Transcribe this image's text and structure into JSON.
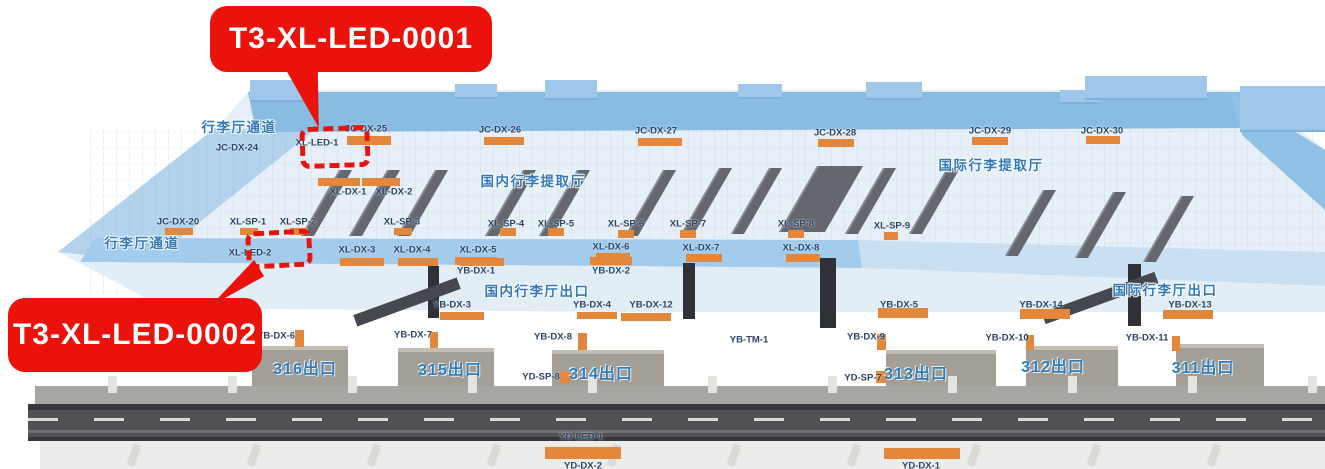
{
  "callouts": [
    {
      "id": "T3-XL-LED-0001",
      "label": "T3-XL-LED-0001"
    },
    {
      "id": "T3-XL-LED-0002",
      "label": "T3-XL-LED-0002"
    }
  ],
  "colors": {
    "callout_red": "#ea120b",
    "orange_marker": "#e2873b",
    "code_text": "#2b4568",
    "area_text": "#3279ba",
    "exit_text": "#2e7dbd"
  },
  "map": {
    "areas": [
      [
        239,
        126,
        "行李厅通道"
      ],
      [
        142,
        242,
        "行李厅通道"
      ],
      [
        533,
        180,
        "国内行李提取厅"
      ],
      [
        991,
        164,
        "国际行李提取厅"
      ],
      [
        537,
        290,
        "国内行李厅出口"
      ],
      [
        1165,
        289,
        "国际行李厅出口"
      ]
    ],
    "exits": [
      [
        305,
        367,
        "316出口"
      ],
      [
        450,
        368,
        "315出口"
      ],
      [
        601,
        372,
        "314出口"
      ],
      [
        916,
        372,
        "313出口"
      ],
      [
        1053,
        365,
        "312出口"
      ],
      [
        1203,
        366,
        "311出口"
      ]
    ],
    "codes": [
      [
        237,
        148,
        "JC-DX-24"
      ],
      [
        366,
        129,
        "JC-DX-25"
      ],
      [
        500,
        130,
        "JC-DX-26"
      ],
      [
        656,
        131,
        "JC-DX-27"
      ],
      [
        835,
        133,
        "JC-DX-28"
      ],
      [
        990,
        131,
        "JC-DX-29"
      ],
      [
        1102,
        131,
        "JC-DX-30"
      ],
      [
        178,
        222,
        "JC-DX-20"
      ],
      [
        317,
        143,
        "XL-LED-1"
      ],
      [
        348,
        192,
        "XL-DX-1"
      ],
      [
        394,
        192,
        "XL-DX-2"
      ],
      [
        248,
        222,
        "XL-SP-1"
      ],
      [
        298,
        222,
        "XL-SP-2"
      ],
      [
        402,
        222,
        "XL-SP-3"
      ],
      [
        506,
        224,
        "XL-SP-4"
      ],
      [
        556,
        224,
        "XL-SP-5"
      ],
      [
        626,
        224,
        "XL-SP-6"
      ],
      [
        688,
        224,
        "XL-SP-7"
      ],
      [
        796,
        224,
        "XL-SP-8"
      ],
      [
        892,
        226,
        "XL-SP-9"
      ],
      [
        250,
        253,
        "XL-LED-2"
      ],
      [
        357,
        250,
        "XL-DX-3"
      ],
      [
        412,
        250,
        "XL-DX-4"
      ],
      [
        478,
        250,
        "XL-DX-5"
      ],
      [
        611,
        247,
        "XL-DX-6"
      ],
      [
        701,
        248,
        "XL-DX-7"
      ],
      [
        801,
        248,
        "XL-DX-8"
      ],
      [
        476,
        271,
        "YB-DX-1"
      ],
      [
        611,
        271,
        "YB-DX-2"
      ],
      [
        452,
        305,
        "YB-DX-3"
      ],
      [
        592,
        305,
        "YB-DX-4"
      ],
      [
        651,
        305,
        "YB-DX-12"
      ],
      [
        899,
        305,
        "YB-DX-5"
      ],
      [
        1041,
        305,
        "YB-DX-14"
      ],
      [
        1190,
        305,
        "YB-DX-13"
      ],
      [
        276,
        336,
        "YB-DX-6"
      ],
      [
        413,
        335,
        "YB-DX-7"
      ],
      [
        553,
        337,
        "YB-DX-8"
      ],
      [
        749,
        340,
        "YB-TM-1"
      ],
      [
        866,
        337,
        "YB-DX-9"
      ],
      [
        1007,
        338,
        "YB-DX-10"
      ],
      [
        1147,
        338,
        "YB-DX-11"
      ],
      [
        541,
        377,
        "YD-SP-8"
      ],
      [
        863,
        378,
        "YD-SP-7"
      ],
      [
        581,
        437,
        "YD-LED-1"
      ],
      [
        583,
        466,
        "YD-DX-2"
      ],
      [
        921,
        466,
        "YD-DX-1"
      ]
    ],
    "orange_bars": [
      [
        347,
        136,
        44,
        9
      ],
      [
        484,
        137,
        40,
        8
      ],
      [
        638,
        138,
        44,
        8
      ],
      [
        818,
        139,
        36,
        8
      ],
      [
        972,
        137,
        36,
        8
      ],
      [
        1086,
        136,
        34,
        8
      ],
      [
        165,
        228,
        28,
        7
      ],
      [
        318,
        178,
        42,
        8
      ],
      [
        362,
        178,
        38,
        8
      ],
      [
        240,
        228,
        18,
        7
      ],
      [
        290,
        228,
        18,
        7
      ],
      [
        394,
        228,
        18,
        7
      ],
      [
        500,
        228,
        16,
        8
      ],
      [
        548,
        228,
        16,
        8
      ],
      [
        618,
        230,
        16,
        8
      ],
      [
        680,
        230,
        16,
        8
      ],
      [
        788,
        230,
        16,
        8
      ],
      [
        884,
        232,
        14,
        8
      ],
      [
        340,
        258,
        44,
        8
      ],
      [
        398,
        258,
        40,
        8
      ],
      [
        460,
        258,
        44,
        8
      ],
      [
        596,
        253,
        34,
        8
      ],
      [
        686,
        254,
        36,
        8
      ],
      [
        786,
        254,
        34,
        8
      ],
      [
        455,
        257,
        42,
        8
      ],
      [
        590,
        257,
        42,
        8
      ],
      [
        440,
        312,
        44,
        8
      ],
      [
        577,
        312,
        40,
        7
      ],
      [
        621,
        313,
        50,
        8
      ],
      [
        878,
        308,
        50,
        10
      ],
      [
        1020,
        309,
        50,
        10
      ],
      [
        1163,
        310,
        50,
        9
      ],
      [
        545,
        447,
        76,
        12
      ],
      [
        884,
        448,
        76,
        11
      ]
    ],
    "orange_markers": [
      [
        295,
        330,
        9,
        17
      ],
      [
        430,
        332,
        8,
        16
      ],
      [
        578,
        333,
        9,
        17
      ],
      [
        877,
        334,
        9,
        16
      ],
      [
        1026,
        335,
        8,
        15
      ],
      [
        1172,
        336,
        8,
        15
      ],
      [
        560,
        372,
        10,
        11
      ],
      [
        876,
        371,
        10,
        12
      ]
    ]
  }
}
